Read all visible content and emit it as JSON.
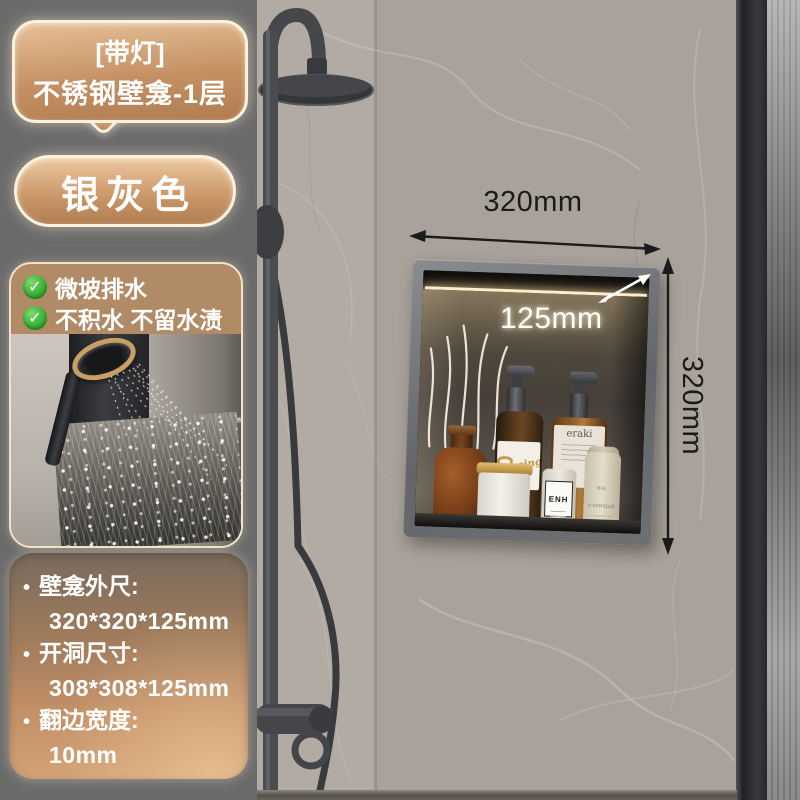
{
  "callout": {
    "line1": "[带灯]",
    "line2": "不锈钢壁龛-1层"
  },
  "color_badge": {
    "label": "银灰色"
  },
  "features": {
    "check_icon": "✓",
    "items": [
      {
        "label": "微坡排水"
      },
      {
        "label": "不积水 不留水渍"
      }
    ]
  },
  "specs": {
    "bullet": "•",
    "items": [
      {
        "label": "壁龛外尺:",
        "value": "320*320*125mm"
      },
      {
        "label": "开洞尺寸:",
        "value": "308*308*125mm"
      },
      {
        "label": "翻边宽度:",
        "value": "10mm"
      }
    ]
  },
  "annotations": {
    "width": "320mm",
    "depth": "125mm",
    "height": "320mm"
  },
  "niche_products": {
    "pump_bottle_label": "Morning",
    "tall_bottle_label": "eraki",
    "white_bottle_label": "ENH",
    "cream_bottle_label": "BAL D'AFRIQUE"
  },
  "colors": {
    "panel_bg": "#6b6b6b",
    "badge_border": "#fcf1dd",
    "badge_bronze_light": "#e6c098",
    "badge_bronze_dark": "#af7b51",
    "feature_card_bg": "#b18b65",
    "check_green": "#3db33a",
    "annotation_black": "#1b1b1b",
    "annotation_white": "#ffffff",
    "marble_wall": "#b1aba3",
    "led_glow": "#ffedc9",
    "niche_frame_gray": "#6f7074"
  }
}
